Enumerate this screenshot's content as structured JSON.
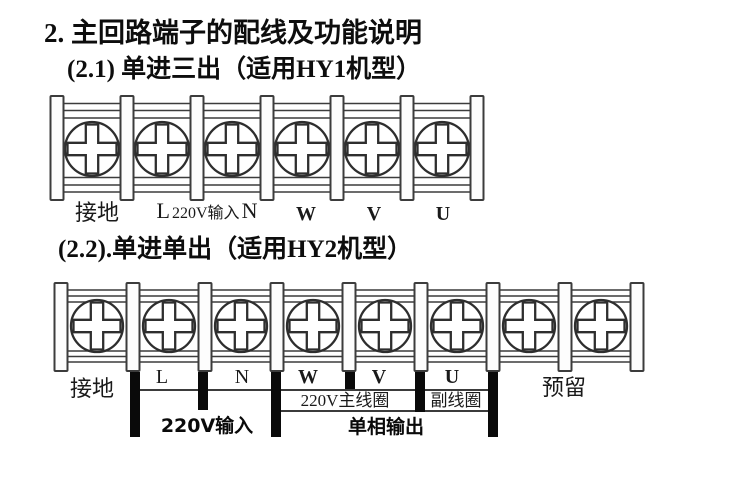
{
  "page_title": "2. 主回路端子的配线及功能说明",
  "colors": {
    "line": "#3c3c3c",
    "wire": "#0a0a0a",
    "text": "#141414"
  },
  "sections": {
    "s1": {
      "heading": "(2.1) 单进三出（适用HY1机型）",
      "terminal_count": 6,
      "labels": {
        "ground": "接地",
        "l": "L",
        "input_small": "220V输入",
        "n": "N",
        "w": "W",
        "v": "V",
        "u": "U"
      }
    },
    "s2": {
      "heading": "(2.2).单进单出（适用HY2机型）",
      "terminal_count": 8,
      "labels": {
        "ground": "接地",
        "l": "L",
        "n": "N",
        "w": "W",
        "v": "V",
        "u": "U",
        "reserved": "预留"
      },
      "annotations": {
        "main_coil": "220V主线圈",
        "aux_coil": "副线圈",
        "input": "220V输入",
        "output": "单相输出"
      }
    }
  }
}
